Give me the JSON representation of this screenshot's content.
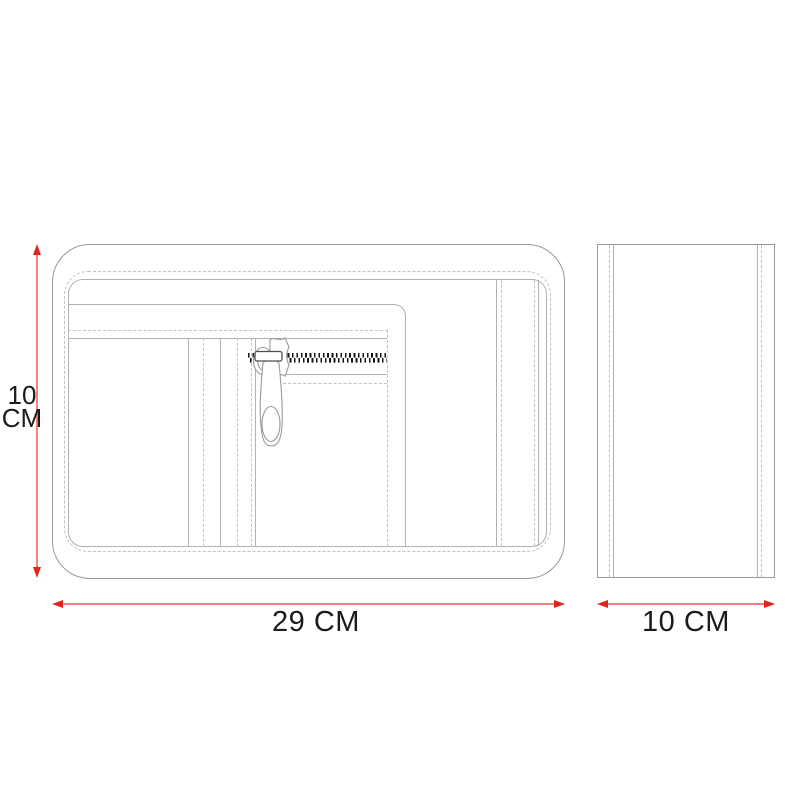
{
  "diagram": {
    "type": "technical-drawing",
    "subject": "zippered pouch organizer with front and side views",
    "views": {
      "front": {
        "name": "front view",
        "height_dimension": {
          "value": 10,
          "unit": "CM",
          "label_lines": [
            "10",
            "CM"
          ]
        },
        "width_dimension": {
          "value": 29,
          "unit": "CM",
          "label": "29 CM"
        }
      },
      "side": {
        "name": "side view",
        "width_dimension": {
          "value": 10,
          "unit": "CM",
          "label": "10 CM"
        }
      }
    },
    "colors": {
      "outline": "#999999",
      "outline_2": "#b2b2b2",
      "stitch": "#c2c2c2",
      "dimension_line": "#ef857c",
      "dimension_arrow": "#e2241a",
      "zipper_teeth": "#141414",
      "label_text": "#1b1b1b"
    }
  }
}
